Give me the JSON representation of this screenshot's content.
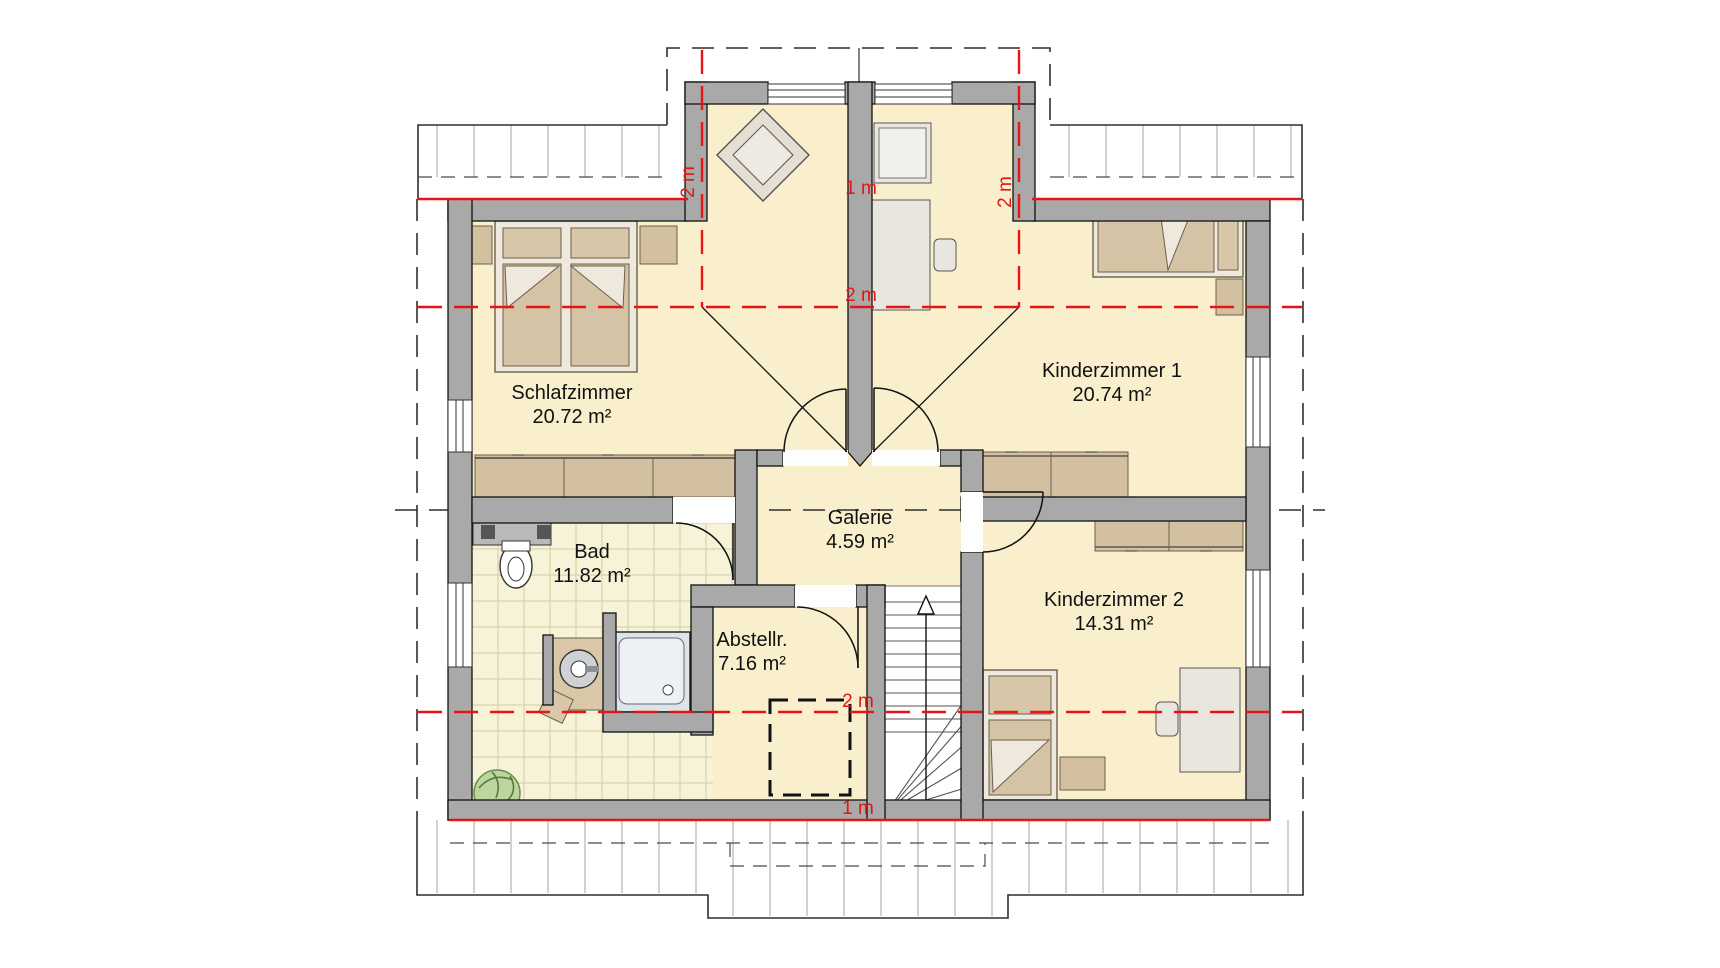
{
  "rooms": [
    {
      "id": "schlafzimmer",
      "name": "Schlafzimmer",
      "area": "20.72 m²"
    },
    {
      "id": "kinderzimmer1",
      "name": "Kinderzimmer 1",
      "area": "20.74 m²"
    },
    {
      "id": "kinderzimmer2",
      "name": "Kinderzimmer 2",
      "area": "14.31 m²"
    },
    {
      "id": "bad",
      "name": "Bad",
      "area": "11.82 m²"
    },
    {
      "id": "abstellraum",
      "name": "Abstellr.",
      "area": "7.16 m²"
    },
    {
      "id": "galerie",
      "name": "Galerie",
      "area": "4.59 m²"
    }
  ],
  "height_labels": {
    "dormer_left_2m": "2 m",
    "dormer_right_2m": "2 m",
    "center_1m": "1 m",
    "center_2m": "2 m",
    "bottom_2m": "2 m",
    "bottom_1m": "1 m"
  },
  "colors": {
    "floor": "#f9efcd",
    "tiles": "#f7f3d8",
    "wall": "#a9a9a9",
    "furniture": "#d3c0a0",
    "height_line_red": "#e81414"
  }
}
